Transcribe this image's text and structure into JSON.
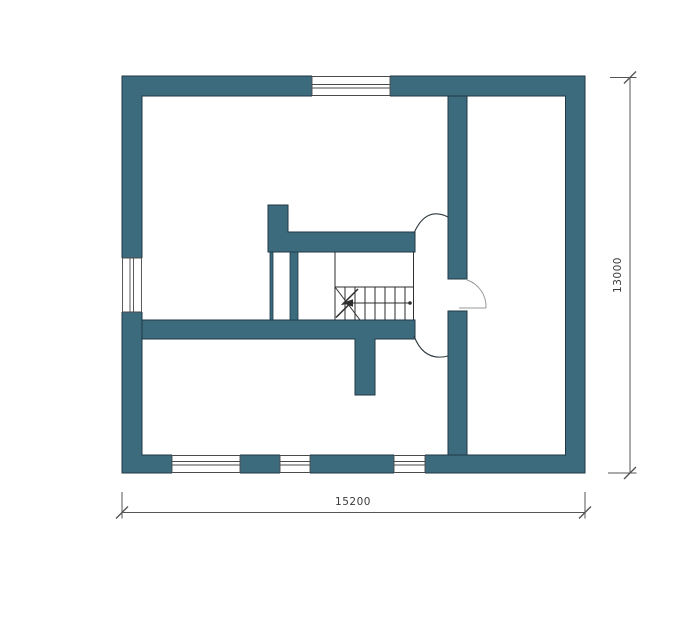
{
  "drawing": {
    "type": "architectural-floor-plan",
    "dimension_labels": {
      "width": "15200",
      "height": "13000"
    },
    "stairs": {
      "tread_count": 8,
      "arrow_direction": "left"
    }
  },
  "colors": {
    "background": "#ffffff",
    "wall_fill": "#3d6b7e",
    "wall_outline": "#1e3a46",
    "window_line": "#4a4a4a",
    "stair_line": "#2e2e2e",
    "door_arc_dark": "#2f3b40",
    "door_arc_light": "#9a9a9a",
    "dimension_line": "#555555",
    "dimension_text": "#3a3a3a"
  }
}
